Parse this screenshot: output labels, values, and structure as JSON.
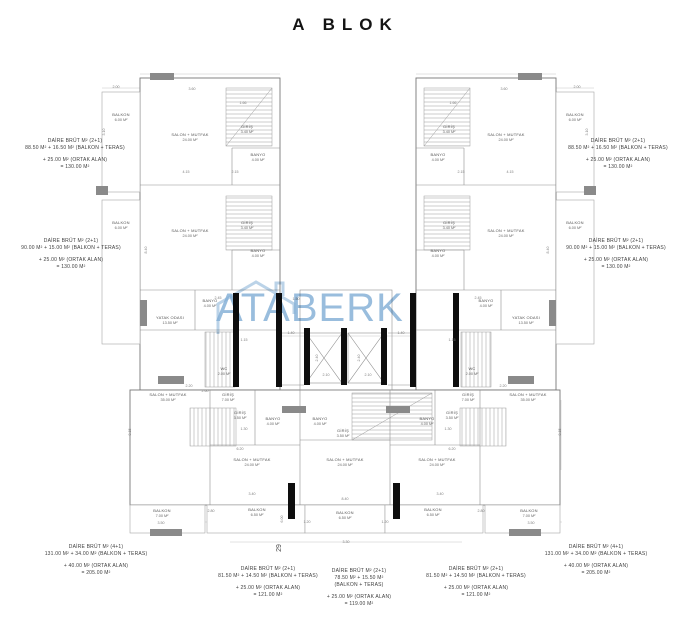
{
  "title": "A BLOK",
  "watermark": {
    "text": "ATABERK",
    "color": "#83afd6",
    "logo": "house-outline"
  },
  "unit_annotations": {
    "left_top": {
      "lines": [
        "DAİRE BRÜT M² (2+1)",
        "88.50 M² + 16.50 M² (BALKON + TERAS)",
        "+ 25.00 M² (ORTAK ALAN)",
        "= 130.00 M²"
      ]
    },
    "left_mid": {
      "lines": [
        "DAİRE BRÜT M² (2+1)",
        "90.00 M² + 15.00 M² (BALKON + TERAS)",
        "+ 25.00 M² (ORTAK ALAN)",
        "= 130.00 M²"
      ]
    },
    "right_top": {
      "lines": [
        "DAİRE BRÜT M² (2+1)",
        "88.50 M² + 16.50 M² (BALKON + TERAS)",
        "+ 25.00 M² (ORTAK ALAN)",
        "= 130.00 M²"
      ]
    },
    "right_mid": {
      "lines": [
        "DAİRE BRÜT M² (2+1)",
        "90.00 M² + 15.00 M² (BALKON + TERAS)",
        "+ 25.00 M² (ORTAK ALAN)",
        "= 130.00 M²"
      ]
    },
    "bottom_left": {
      "lines": [
        "DAİRE BRÜT M² (4+1)",
        "131.00 M² + 34.00 M² (BALKON + TERAS)",
        "+ 40.00 M² (ORTAK ALAN)",
        "= 205.00 M²"
      ]
    },
    "bottom_center_left": {
      "lines": [
        "DAİRE BRÜT M² (2+1)",
        "81.50 M² + 14.50 M² (BALKON + TERAS)",
        "+ 25.00 M² (ORTAK ALAN)",
        "= 121.00 M²"
      ]
    },
    "bottom_center_mid": {
      "lines": [
        "DAİRE BRÜT M² (2+1)",
        "78.50 M² + 15.50 M²",
        "(BALKON + TERAS)",
        "+ 25.00 M² (ORTAK ALAN)",
        "= 119.00 M²"
      ]
    },
    "bottom_center_right": {
      "lines": [
        "DAİRE BRÜT M² (2+1)",
        "81.50 M² + 14.50 M² (BALKON + TERAS)",
        "+ 25.00 M² (ORTAK ALAN)",
        "= 121.00 M²"
      ]
    },
    "bottom_right": {
      "lines": [
        "DAİRE BRÜT M² (4+1)",
        "131.00 M² + 34.00 M² (BALKON + TERAS)",
        "+ 40.00 M² (ORTAK ALAN)",
        "= 205.00 M²"
      ]
    }
  },
  "room_labels": {
    "salon_mutfak": "SALON + MUTFAK",
    "salon_24": "24.00 M²",
    "salon_35": "35.00 M²",
    "yatak_odasi": "YATAK ODASI",
    "yatak_135": "13.50 M²",
    "banyo": "BANYO",
    "banyo_4": "4.00 M²",
    "giris": "GİRİŞ",
    "giris_34": "3.40 M²",
    "giris_35": "3.50 M²",
    "giris_70": "7.00 M²",
    "balkon": "BALKON",
    "balkon_60": "6.00 M²",
    "balkon_65": "6.50 M²",
    "balkon_70": "7.00 M²",
    "wc": "WC",
    "wc_20": "2.00 M²"
  },
  "dimensions": [
    "2.00",
    "3.10",
    "3.60",
    "1.66",
    "8.40",
    "4.15",
    "2.15",
    "2.45",
    "1.15",
    "1.40",
    "2.10",
    "2.40",
    "6.20",
    "3.40",
    "1.20",
    "3.30",
    "6.00",
    "2.80",
    "3.50",
    "8.15",
    "2.20",
    "1.30",
    "2.60",
    "1.50"
  ],
  "section_marker": "29",
  "colors": {
    "line": "#8f8f8f",
    "wall_dark": "#777777",
    "shaft": "#0e0e0e",
    "text": "#3d3d3d",
    "watermark": "#83afd6"
  }
}
